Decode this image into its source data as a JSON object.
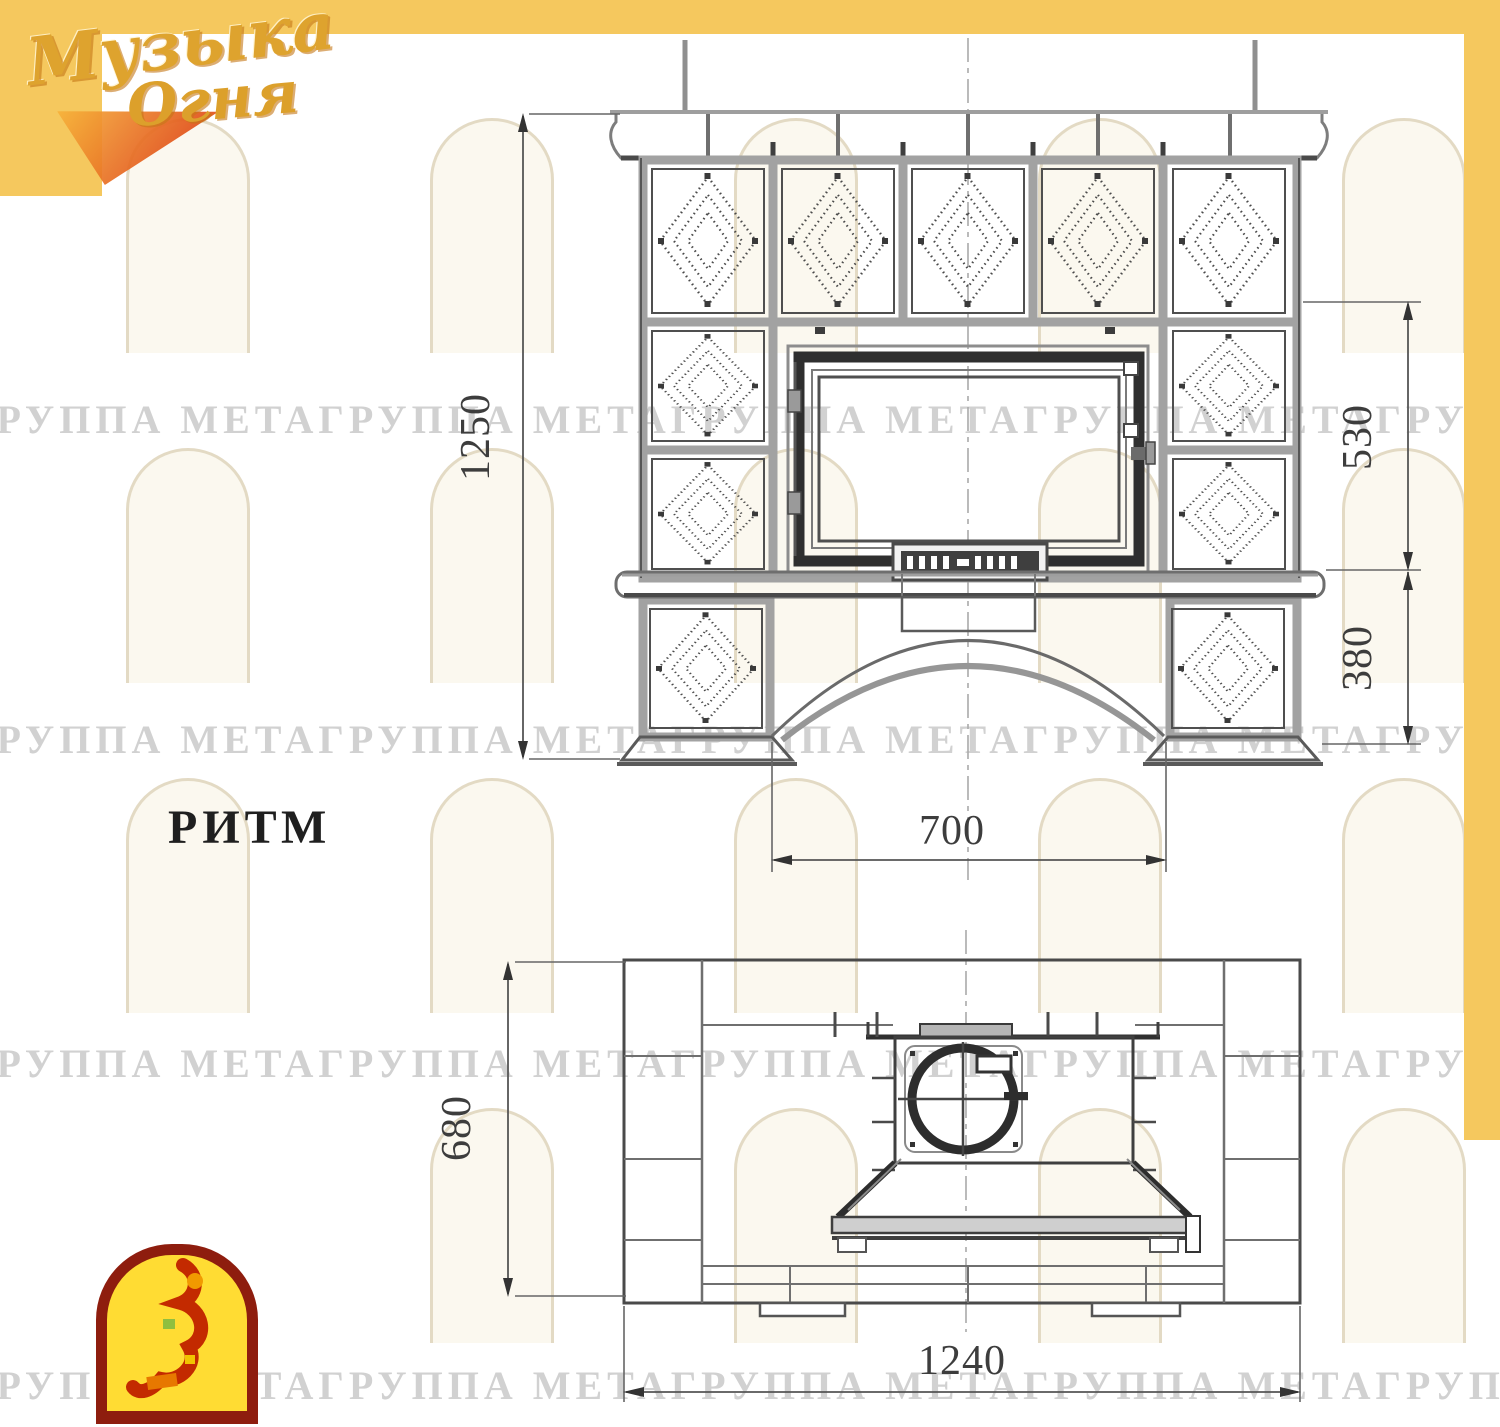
{
  "page": {
    "accent_gold": "#F5C85E",
    "background": "#FFFFFF"
  },
  "brand": {
    "line1": "Музыка",
    "line2": "Огня"
  },
  "watermark": {
    "unit": "ГРУППА МЕТА",
    "row": "ГРУППА МЕТАГРУППА МЕТАГРУППА МЕТАГРУППА МЕТАГРУППА МЕТАГРУППА МЕТА"
  },
  "model": {
    "label": "РИТМ"
  },
  "front_view": {
    "title": "front elevation",
    "dims": {
      "overall_height": "1250",
      "firebox_height": "530",
      "base_height": "380",
      "opening_width": "700"
    }
  },
  "plan_view": {
    "title": "plan view",
    "dims": {
      "depth": "680",
      "width": "1240"
    }
  }
}
